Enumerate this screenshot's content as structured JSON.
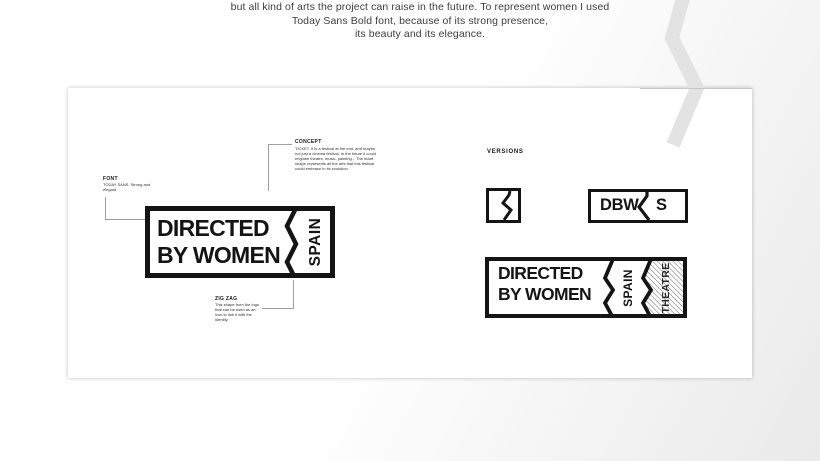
{
  "intro": {
    "lines": [
      "but all kind of arts the project can raise in the future. To represent women I used",
      "Today Sans Bold font, because of its strong presence,",
      "its beauty and its elegance."
    ]
  },
  "annotations": {
    "font": {
      "title": "FONT",
      "body": "TODAY SANS. Strong and elegant."
    },
    "concept": {
      "title": "CONCEPT",
      "body": "TICKET. It is a festival at the end, and maybe not just a cinema festival, in the future it could englobe theatre, music, painting... The ticket shape represents all the arts that this festival could embrace in its evolution."
    },
    "zigzag": {
      "title": "ZIG ZAG",
      "body": "This shape from the logo that can be used as an icon to link it with the identity."
    }
  },
  "logo": {
    "line1": "DIRECTED",
    "line2": "BY WOMEN",
    "country": "SPAIN"
  },
  "versions": {
    "title": "VERSIONS",
    "monogram": {
      "left": "DBW",
      "right": "S"
    },
    "extended": {
      "line1": "DIRECTED",
      "line2": "BY WOMEN",
      "country": "SPAIN",
      "sector": "THEATRE"
    }
  },
  "colors": {
    "logo_ink": "#141414",
    "decoration_gray": "#e3e3e3",
    "connector_gray": "#9f9f9f",
    "card_background": "#ffffff"
  },
  "icons": {
    "decoration": "zigzag-decoration-icon",
    "square_mark": "zigzag-square-mark"
  }
}
